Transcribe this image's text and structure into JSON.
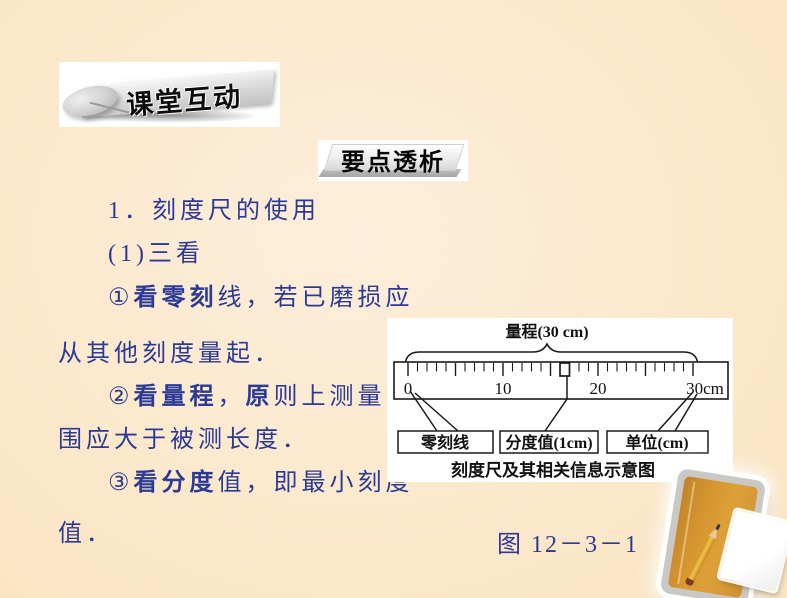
{
  "slide": {
    "background_color": "#fbe8ca",
    "body_text_color": "#2b3a96"
  },
  "banners": {
    "classroom": "课堂互动",
    "key_points": "要点透析"
  },
  "content": {
    "lines": [
      {
        "indent": true,
        "segments": [
          {
            "text": "1．刻度尺的使用",
            "bold": false
          }
        ]
      },
      {
        "indent": true,
        "segments": [
          {
            "text": "(1)三看",
            "bold": false
          }
        ]
      },
      {
        "indent": true,
        "segments": [
          {
            "text": "①",
            "bold": false
          },
          {
            "text": "看零刻",
            "bold": true
          },
          {
            "text": "线，若已磨损应",
            "bold": false
          }
        ]
      },
      {
        "indent": false,
        "segments": [
          {
            "text": "从其他刻度量起．",
            "bold": false
          }
        ]
      },
      {
        "indent": true,
        "segments": [
          {
            "text": "②",
            "bold": false
          },
          {
            "text": "看量程",
            "bold": true
          },
          {
            "text": "，",
            "bold": false
          },
          {
            "text": "原",
            "bold": true
          },
          {
            "text": "则上测量范",
            "bold": false
          }
        ]
      },
      {
        "indent": false,
        "segments": [
          {
            "text": "围应大于被测长度．",
            "bold": false
          }
        ]
      },
      {
        "indent": true,
        "segments": [
          {
            "text": "③",
            "bold": false
          },
          {
            "text": "看分度",
            "bold": true
          },
          {
            "text": "值，即最小刻度",
            "bold": false
          }
        ]
      },
      {
        "indent": false,
        "segments": [
          {
            "text": "值．",
            "bold": false
          }
        ]
      }
    ]
  },
  "figure": {
    "range_label": "量程(30 cm)",
    "ruler": {
      "min_cm": 0,
      "max_cm": 30,
      "major_tick_every_cm": 5,
      "minor_tick_every_cm": 1,
      "division_value_cm": 1,
      "unit": "cm",
      "tick_labels": [
        {
          "cm": 0,
          "label": "0"
        },
        {
          "cm": 10,
          "label": "10"
        },
        {
          "cm": 20,
          "label": "20"
        },
        {
          "cm": 30,
          "label": "30cm"
        }
      ],
      "highlighted_division": {
        "from_cm": 16,
        "to_cm": 17
      }
    },
    "boxes": [
      "零刻线",
      "分度值(1cm)",
      "单位(cm)"
    ],
    "caption": "刻度尺及其相关信息示意图",
    "number": "图 12－3－1"
  }
}
